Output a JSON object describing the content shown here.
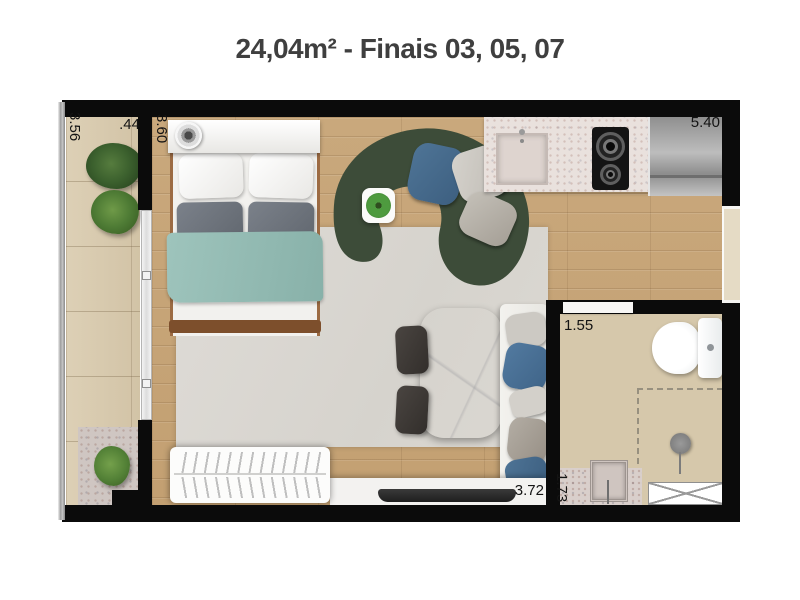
{
  "title": "24,04m² - Finais 03, 05, 07",
  "dimensions": {
    "balcony_length": "3.56",
    "balcony_depth": ".44",
    "bedroom_length": "3.60",
    "unit_width": "5.40",
    "bathroom_width": "1.55",
    "bathroom_counter_length": "1.73",
    "living_width": "3.72"
  },
  "palette": {
    "wall": "#0b0b0b",
    "wood_floor": "#c7a67a",
    "balcony_tile": "#d9cbb0",
    "bathroom_tile": "#d6c8ab",
    "rug": "#dcd9d4",
    "sofa_green": "#3d4c39",
    "blanket_teal": "#94bdb5",
    "pillow_blue": "#4a7095",
    "marble": "#ececea",
    "counter_granite": "#e9e1dd",
    "title_text": "#3f3f3f"
  }
}
